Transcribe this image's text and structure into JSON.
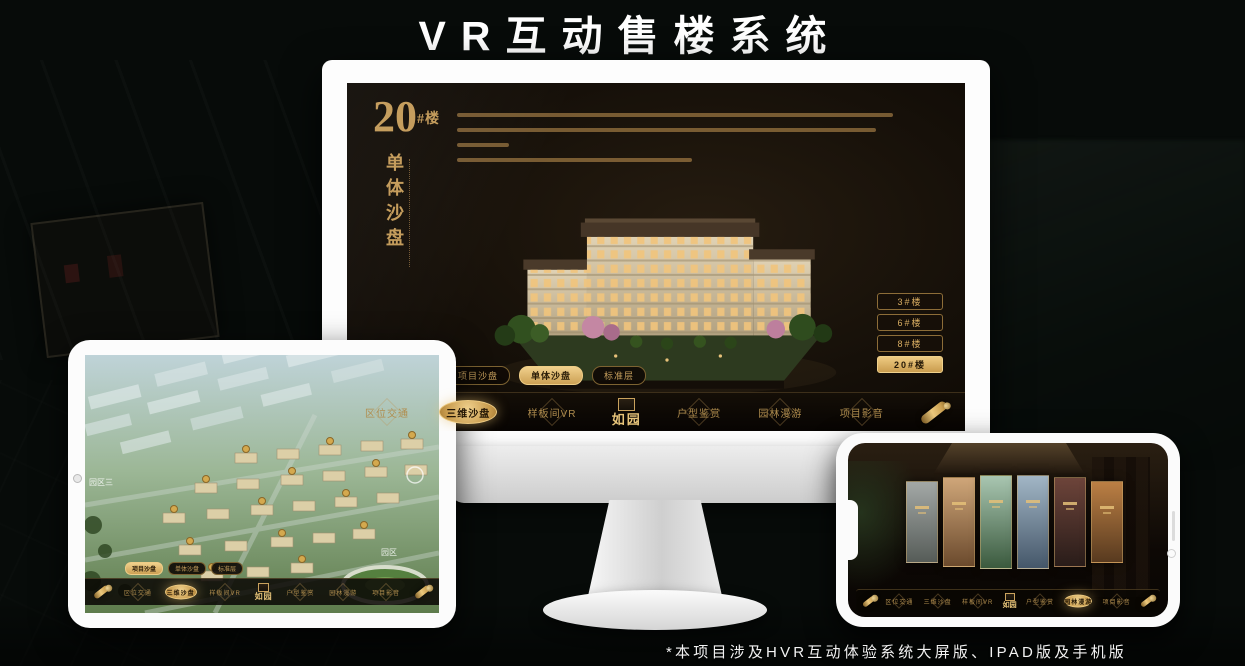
{
  "page": {
    "title": "VR互动售楼系统",
    "footnote": "*本项目涉及HVR互动体验系统大屏版、IPAD版及手机版"
  },
  "colors": {
    "gold": "#c89b5a",
    "gold_bright": "#eecb82",
    "screen_bg": "#161009",
    "nav_bg": "#0b0805",
    "background": "#070b09"
  },
  "monitor_app": {
    "unit_number": "20",
    "unit_suffix": "#楼",
    "unit_subtitle": "单体沙盘",
    "floor_buttons": [
      {
        "label": "3#楼",
        "selected": false
      },
      {
        "label": "6#楼",
        "selected": false
      },
      {
        "label": "8#楼",
        "selected": false
      },
      {
        "label": "20#楼",
        "selected": true
      }
    ],
    "sub_tabs": [
      {
        "label": "项目沙盘",
        "selected": false
      },
      {
        "label": "单体沙盘",
        "selected": true
      },
      {
        "label": "标准层",
        "selected": false
      }
    ],
    "nav_items": [
      {
        "label": "区位交通",
        "selected": false
      },
      {
        "label": "三维沙盘",
        "selected": true
      },
      {
        "label": "样板间VR",
        "selected": false
      },
      {
        "label": "户型鉴赏",
        "selected": false
      },
      {
        "label": "园林漫游",
        "selected": false
      },
      {
        "label": "项目影音",
        "selected": false
      }
    ],
    "logo": "如园"
  },
  "ipad_app": {
    "sub_tabs": [
      {
        "label": "项目沙盘",
        "selected": true
      },
      {
        "label": "单体沙盘",
        "selected": false
      },
      {
        "label": "标准层",
        "selected": false
      }
    ],
    "nav_items": [
      {
        "label": "区位交通",
        "selected": false
      },
      {
        "label": "三维沙盘",
        "selected": true
      },
      {
        "label": "样板间VR",
        "selected": false
      },
      {
        "label": "户型鉴赏",
        "selected": false
      },
      {
        "label": "园林漫游",
        "selected": false
      },
      {
        "label": "项目影音",
        "selected": false
      }
    ],
    "map_labels": [
      "园区三",
      "园区"
    ],
    "logo": "如园"
  },
  "phone_app": {
    "nav_items": [
      {
        "label": "区位交通",
        "selected": false
      },
      {
        "label": "三维沙盘",
        "selected": false
      },
      {
        "label": "样板间VR",
        "selected": false
      },
      {
        "label": "户型鉴赏",
        "selected": false
      },
      {
        "label": "园林漫游",
        "selected": true
      },
      {
        "label": "项目影音",
        "selected": false
      }
    ],
    "logo": "如园"
  }
}
